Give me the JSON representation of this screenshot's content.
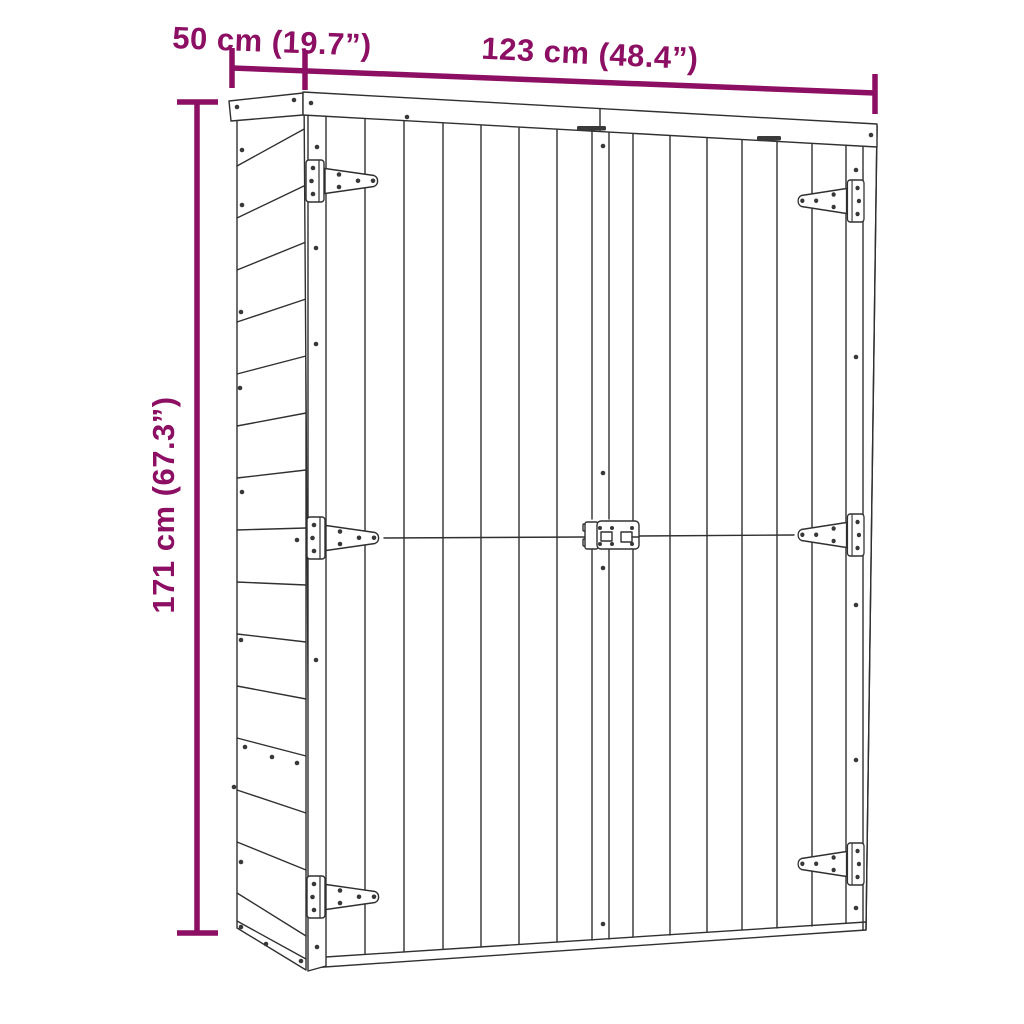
{
  "diagram": {
    "subject": "wooden garden tool shed with double doors, T-hinges and center latch",
    "labels": {
      "depth": "50 cm (19.7”)",
      "width": "123 cm (48.4”)",
      "height": "171 cm (67.3”)"
    },
    "values": {
      "depth_cm": 50,
      "depth_in": 19.7,
      "width_cm": 123,
      "width_in": 48.4,
      "height_cm": 171,
      "height_in": 67.3
    },
    "colors": {
      "dimension_annotation": "#8C0F63",
      "line_art": "#303030",
      "background": "#FFFFFF"
    }
  }
}
